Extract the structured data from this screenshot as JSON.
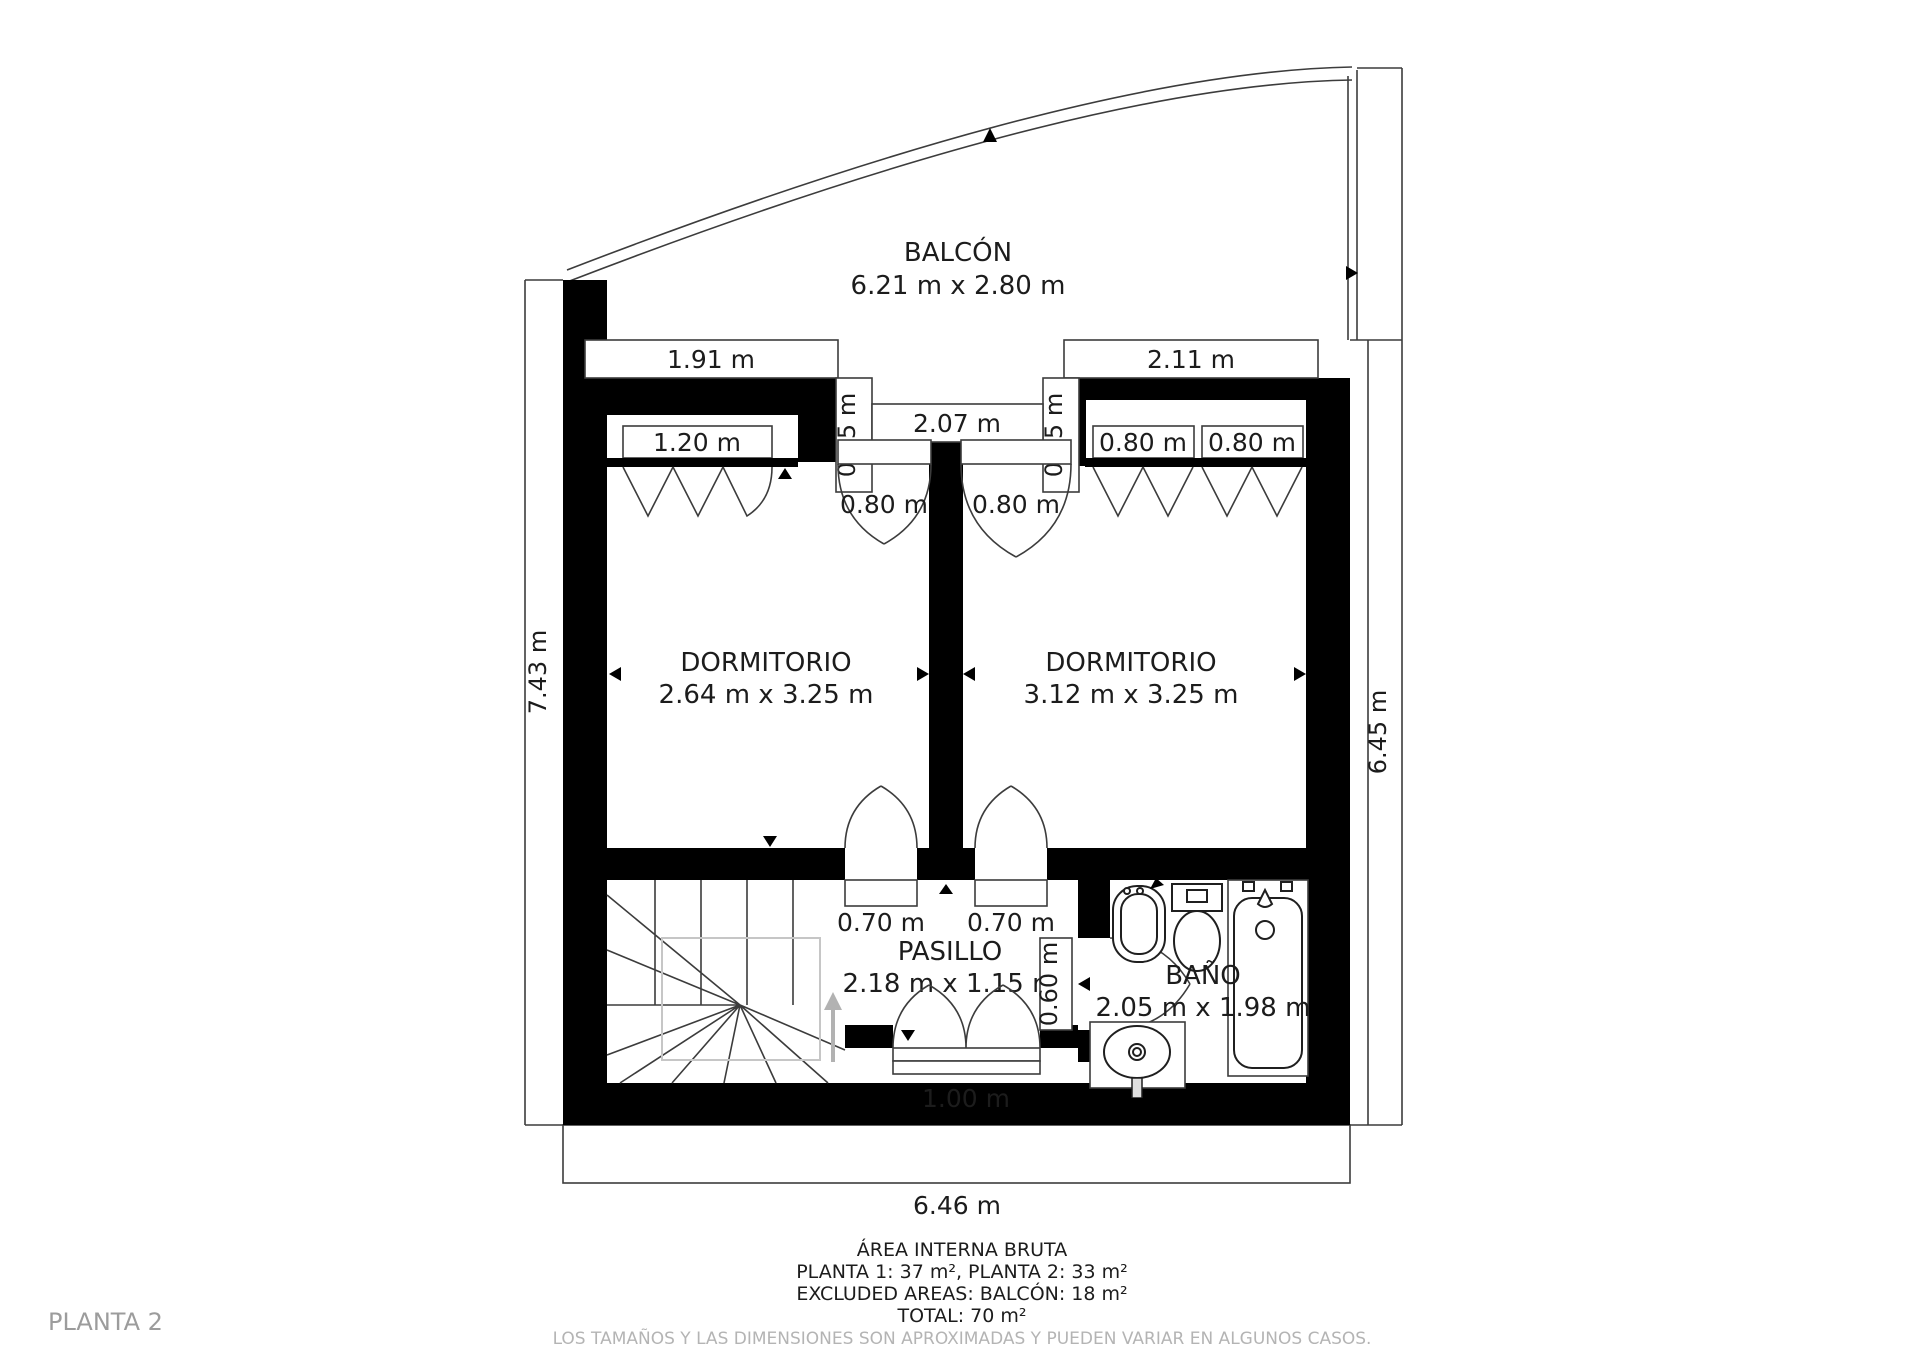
{
  "plan": {
    "floor_label": "PLANTA 2",
    "rooms": {
      "balcony": {
        "name": "BALCÓN",
        "dims": "6.21 m x 2.80 m"
      },
      "bedroom_left": {
        "name": "DORMITORIO",
        "dims": "2.64 m x 3.25 m"
      },
      "bedroom_right": {
        "name": "DORMITORIO",
        "dims": "3.12 m x 3.25 m"
      },
      "hallway": {
        "name": "PASILLO",
        "dims": "2.18 m x 1.15 m"
      },
      "bathroom": {
        "name": "BAÑO",
        "dims": "2.05 m x 1.98 m"
      }
    },
    "dims": {
      "left_total": "7.43 m",
      "right_total": "6.45 m",
      "bottom_total": "6.46 m",
      "top_wall_left": "1.91 m",
      "top_wall_right": "2.11 m",
      "balcony_opening": "2.07 m",
      "balcony_jamb_left": "0.75 m",
      "balcony_jamb_right": "0.75 m",
      "closet_left": "1.20 m",
      "closet_right_1": "0.80 m",
      "closet_right_2": "0.80 m",
      "balcony_door_left": "0.80 m",
      "balcony_door_right": "0.80 m",
      "hall_door_left": "0.70 m",
      "hall_door_right": "0.70 m",
      "bath_door": "0.60 m",
      "hall_bottom_door": "1.00 m"
    },
    "footer": {
      "line1": "ÁREA INTERNA BRUTA",
      "line2": "PLANTA 1: 37 m², PLANTA 2: 33 m²",
      "line3": "EXCLUDED AREAS: BALCÓN: 18 m²",
      "line4": "TOTAL: 70 m²",
      "disclaimer": "LOS TAMAÑOS Y LAS DIMENSIONES SON APROXIMADAS Y PUEDEN VARIAR EN ALGUNOS CASOS."
    },
    "colors": {
      "wall": "#000000",
      "background": "#ffffff",
      "muted_text": "#b4b4b4"
    }
  }
}
